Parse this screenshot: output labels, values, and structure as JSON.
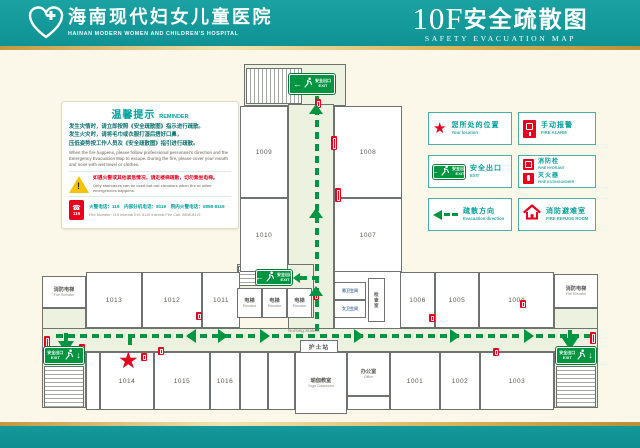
{
  "header": {
    "hospital_name_zh": "海南现代妇女儿童医院",
    "hospital_name_en": "HAINAN MODERN WOMEN AND CHILDREN'S HOSPITAL",
    "floor": "10F",
    "title_zh": "安全疏散图",
    "title_en": "SAFETY EVACUATION MAP"
  },
  "reminder": {
    "title_zh": "温馨提示",
    "title_en": "REMINDER",
    "lines_zh": [
      "发生灾情时，请立即按照《安全疏散图》指示进行疏散。",
      "发生火灾时，请将毛巾或衣服打湿后捂好口鼻，",
      "压低姿势按工作人员及《安全疏散图》指引进行疏散。"
    ],
    "text_en": "When the fire happens, please follow professional personnel's direction and the Emergency Evacuation Map to escape. During the fire, please cover your mouth and nose with wet towel or clothes.",
    "warning_zh": "如遇火警或其他紧急情况，请走楼梯疏散，切勿乘坐电梯。",
    "warning_en": "Only staircases can be used but not elevators when fire or other emergencies happens.",
    "phone_badge": "119",
    "phone_zh": "火警电话：119　内部分机电话：8119　院内火警电话：0898-8119",
    "phone_en": "Fire Number: 119   Internal Ext: 8119   Internal Fire Call: 0898-8119"
  },
  "legend": {
    "cols": [
      428,
      518
    ],
    "col_w": [
      84,
      78
    ],
    "rows": [
      112,
      155,
      198
    ],
    "row_h": 33,
    "items": [
      {
        "id": "your-location",
        "icon": "star",
        "zh": "您所处的位置",
        "en": "Your location",
        "col": 0,
        "row": 0
      },
      {
        "id": "fire-alarm",
        "icon": "alarm",
        "zh": "手动报警",
        "en": "FIRE ALARM",
        "col": 1,
        "row": 0
      },
      {
        "id": "safety-exit",
        "icon": "exit",
        "zh": "安全出口",
        "en": "EXIT",
        "col": 0,
        "row": 1
      },
      {
        "id": "hydrant-extinguisher",
        "icon": "double",
        "col": 1,
        "row": 1,
        "rows": [
          {
            "icon": "hydrant",
            "zh": "消防栓",
            "en": "FIRE HYDRANT"
          },
          {
            "icon": "extinguisher",
            "zh": "灭火器",
            "en": "FIRE EXTINGUISHER"
          }
        ]
      },
      {
        "id": "evacuation-direction",
        "icon": "arrow",
        "zh": "疏散方向",
        "en": "Evacuation direction",
        "col": 0,
        "row": 2
      },
      {
        "id": "fire-refuge-room",
        "icon": "house",
        "zh": "消防避难室",
        "en": "FIRE REFUGE ROOM",
        "col": 1,
        "row": 2
      }
    ]
  },
  "map": {
    "exit_label": {
      "zh": "安全出口",
      "en": "EXIT"
    },
    "nursing": {
      "zh": "护士站",
      "en": "Nursing Station",
      "box": {
        "x": 300,
        "y": 340,
        "w": 38,
        "h": 13
      },
      "en_pos": {
        "x": 288,
        "y": 328
      }
    },
    "star": {
      "x": 118,
      "y": 349
    },
    "corridors": [
      {
        "name": "top-lobby",
        "x": 244,
        "y": 64,
        "w": 102,
        "h": 42
      },
      {
        "name": "vertical-corridor",
        "x": 288,
        "y": 104,
        "w": 46,
        "h": 226
      },
      {
        "name": "central-lobby",
        "x": 237,
        "y": 264,
        "w": 77,
        "h": 54
      },
      {
        "name": "utility-block",
        "x": 334,
        "y": 270,
        "w": 68,
        "h": 60,
        "white": true
      },
      {
        "name": "left-lobby",
        "x": 42,
        "y": 308,
        "w": 44,
        "h": 100
      },
      {
        "name": "right-lobby",
        "x": 554,
        "y": 308,
        "w": 44,
        "h": 100
      },
      {
        "name": "main-corridor",
        "x": 42,
        "y": 328,
        "w": 556,
        "h": 24
      }
    ],
    "stairs": [
      {
        "name": "staircase-top",
        "x": 246,
        "y": 68,
        "w": 56,
        "h": 36,
        "dir": "v"
      },
      {
        "name": "staircase-central",
        "x": 238,
        "y": 266,
        "w": 20,
        "h": 20,
        "dir": "h"
      },
      {
        "name": "staircase-left",
        "x": 44,
        "y": 366,
        "w": 40,
        "h": 42,
        "dir": "h"
      },
      {
        "name": "staircase-right",
        "x": 556,
        "y": 366,
        "w": 40,
        "h": 42,
        "dir": "h"
      }
    ],
    "rooms": [
      {
        "num": "1009",
        "x": 240,
        "y": 106,
        "w": 48,
        "h": 92
      },
      {
        "num": "1010",
        "x": 240,
        "y": 198,
        "w": 48,
        "h": 74
      },
      {
        "num": "1008",
        "x": 334,
        "y": 106,
        "w": 68,
        "h": 92
      },
      {
        "num": "1007",
        "x": 334,
        "y": 198,
        "w": 68,
        "h": 74
      },
      {
        "id": "fire-elevator-left",
        "zh": "消防电梯",
        "en": "Fire Elevator",
        "x": 42,
        "y": 276,
        "w": 44,
        "h": 32
      },
      {
        "num": "1013",
        "x": 86,
        "y": 272,
        "w": 56,
        "h": 56
      },
      {
        "num": "1012",
        "x": 142,
        "y": 272,
        "w": 60,
        "h": 56
      },
      {
        "num": "1011",
        "x": 202,
        "y": 272,
        "w": 38,
        "h": 56
      },
      {
        "num": "1006",
        "x": 400,
        "y": 272,
        "w": 35,
        "h": 56
      },
      {
        "num": "1005",
        "x": 435,
        "y": 272,
        "w": 44,
        "h": 56
      },
      {
        "num": "1004",
        "x": 479,
        "y": 272,
        "w": 75,
        "h": 56
      },
      {
        "id": "fire-elevator-right",
        "zh": "消防电梯",
        "en": "Fire Elevator",
        "x": 554,
        "y": 274,
        "w": 44,
        "h": 34
      },
      {
        "x": 86,
        "y": 352,
        "w": 14,
        "h": 58
      },
      {
        "num": "1014",
        "x": 100,
        "y": 352,
        "w": 54,
        "h": 58
      },
      {
        "num": "1015",
        "x": 154,
        "y": 352,
        "w": 56,
        "h": 58
      },
      {
        "num": "1016",
        "x": 210,
        "y": 352,
        "w": 30,
        "h": 58
      },
      {
        "x": 240,
        "y": 352,
        "w": 28,
        "h": 58
      },
      {
        "x": 268,
        "y": 352,
        "w": 27,
        "h": 58
      },
      {
        "id": "yoga-classroom",
        "zh": "瑜伽教室",
        "en": "Yoga Classroom",
        "x": 295,
        "y": 352,
        "w": 52,
        "h": 62
      },
      {
        "id": "office",
        "zh": "办公室",
        "en": "Office",
        "x": 347,
        "y": 352,
        "w": 43,
        "h": 44
      },
      {
        "x": 347,
        "y": 396,
        "w": 43,
        "h": 14
      },
      {
        "num": "1001",
        "x": 390,
        "y": 352,
        "w": 50,
        "h": 58
      },
      {
        "num": "1002",
        "x": 440,
        "y": 352,
        "w": 40,
        "h": 58
      },
      {
        "num": "1003",
        "x": 480,
        "y": 352,
        "w": 74,
        "h": 58
      },
      {
        "id": "elevator-1",
        "zh": "电梯",
        "en": "Elevator",
        "x": 237,
        "y": 288,
        "w": 25,
        "h": 30
      },
      {
        "id": "elevator-2",
        "zh": "电梯",
        "en": "Elevator",
        "x": 262,
        "y": 288,
        "w": 25,
        "h": 30
      },
      {
        "id": "elevator-3",
        "zh": "电梯",
        "en": "Elevator",
        "x": 287,
        "y": 288,
        "w": 25,
        "h": 30
      },
      {
        "id": "washroom-men",
        "zh": "男卫生间",
        "x": 334,
        "y": 282,
        "w": 32,
        "h": 18,
        "small": true
      },
      {
        "id": "washroom-women",
        "zh": "女卫生间",
        "x": 334,
        "y": 300,
        "w": 32,
        "h": 18,
        "small": true
      },
      {
        "id": "exam-room",
        "zh": "检查室",
        "x": 368,
        "y": 278,
        "w": 17,
        "h": 44,
        "vertical": true
      }
    ],
    "exit_signs": [
      {
        "name": "exit-sign-top",
        "x": 289,
        "y": 74,
        "w": 46,
        "h": 20,
        "variant": "left"
      },
      {
        "name": "exit-sign-central",
        "x": 256,
        "y": 270,
        "w": 36,
        "h": 15,
        "variant": "left"
      },
      {
        "name": "exit-sign-left",
        "x": 44,
        "y": 347,
        "w": 40,
        "h": 17,
        "variant": "down"
      },
      {
        "name": "exit-sign-right",
        "x": 556,
        "y": 347,
        "w": 40,
        "h": 17,
        "variant": "down"
      }
    ],
    "dashes": [
      {
        "o": "h",
        "x": 56,
        "y": 334,
        "len": 534
      },
      {
        "o": "v",
        "x": 315,
        "y": 96,
        "len": 236
      },
      {
        "o": "h",
        "x": 300,
        "y": 276,
        "len": 16
      },
      {
        "o": "v",
        "x": 128,
        "y": 338,
        "len": 11
      }
    ],
    "arrows": [
      {
        "dir": "up",
        "x": 309,
        "y": 104,
        "s": 7
      },
      {
        "dir": "up",
        "x": 309,
        "y": 208,
        "s": 7
      },
      {
        "dir": "up",
        "x": 309,
        "y": 286,
        "s": 7
      },
      {
        "dir": "left",
        "x": 293,
        "y": 273,
        "s": 5
      },
      {
        "dir": "left",
        "x": 186,
        "y": 329,
        "s": 7
      },
      {
        "dir": "right",
        "x": 218,
        "y": 329,
        "s": 7
      },
      {
        "dir": "right",
        "x": 260,
        "y": 329,
        "s": 7
      },
      {
        "dir": "right",
        "x": 354,
        "y": 329,
        "s": 7
      },
      {
        "dir": "right",
        "x": 450,
        "y": 329,
        "s": 7
      },
      {
        "dir": "right",
        "x": 524,
        "y": 329,
        "s": 7
      },
      {
        "dir": "down",
        "x": 58,
        "y": 341,
        "s": 8,
        "shaft": true
      },
      {
        "dir": "down",
        "x": 562,
        "y": 338,
        "s": 8,
        "shaft": true
      }
    ],
    "red_icons": [
      [
        315,
        99,
        9
      ],
      [
        331,
        136,
        14
      ],
      [
        335,
        188,
        14
      ],
      [
        313,
        291,
        9
      ],
      [
        196,
        312,
        8
      ],
      [
        429,
        314,
        8
      ],
      [
        520,
        300,
        8
      ],
      [
        44,
        336,
        12
      ],
      [
        79,
        344,
        8
      ],
      [
        158,
        347,
        8
      ],
      [
        141,
        353,
        8
      ],
      [
        590,
        332,
        12
      ],
      [
        493,
        348,
        8
      ]
    ]
  },
  "colors": {
    "teal": "#12989a",
    "gold": "#c9a24b",
    "green": "#009540",
    "red": "#e8001e",
    "pale": "#edf2e0"
  }
}
